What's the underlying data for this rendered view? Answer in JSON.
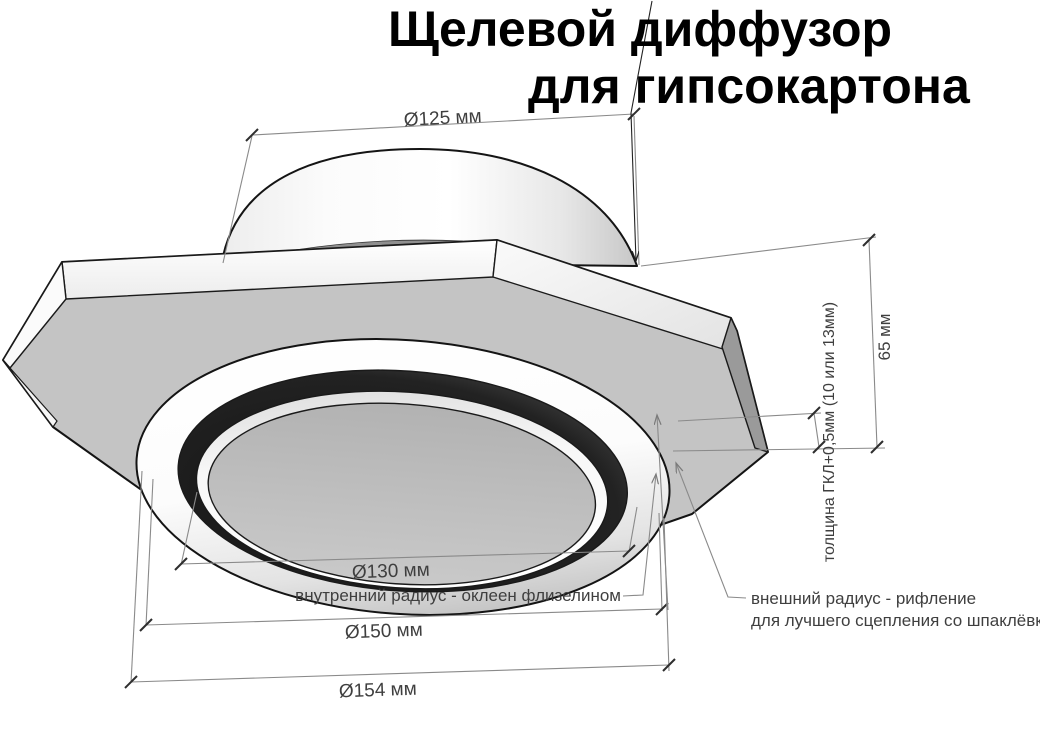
{
  "title": {
    "line1": "Щелевой диффузор",
    "line2": "для гипсокартона"
  },
  "dimensions": {
    "duct_diameter": "Ø125 мм",
    "total_height": "65 мм",
    "gkl_thickness": "толщина ГКЛ+0,5мм (10 или 13мм)",
    "inner_diameter": "Ø130 мм",
    "outer_diameter": "Ø150 мм",
    "flange_diameter": "Ø154 мм"
  },
  "annotations": {
    "inner_radius": "внутренний радиус - оклеен флизелином",
    "outer_radius_line1": "внешний радиус - рифление",
    "outer_radius_line2": "для лучшего сцепления со шпаклёвкой"
  },
  "colors": {
    "background": "#ffffff",
    "outline": "#141414",
    "dimension_line": "#8a8a8a",
    "dimension_text": "#3f3f3f",
    "title_text": "#000000",
    "plate_face": "#c4c4c4",
    "slot_dark": "#1f1f1f",
    "disc_face": "#bdbdbd"
  }
}
